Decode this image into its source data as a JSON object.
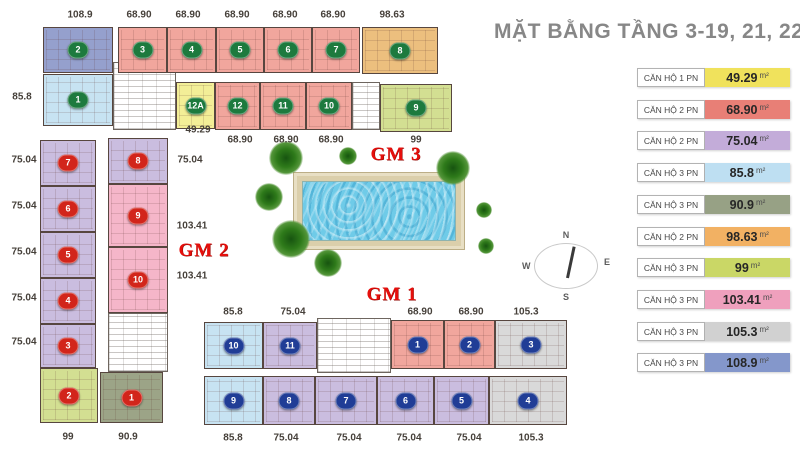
{
  "title": "MẶT BẰNG TẦNG 3-19, 21, 22",
  "legend": {
    "rows": [
      {
        "label": "CĂN HỘ 1 PN",
        "area": "49.29",
        "unit": "m²",
        "color": "#f0e25c"
      },
      {
        "label": "CĂN HỘ 2 PN",
        "area": "68.90",
        "unit": "m²",
        "color": "#e87f76"
      },
      {
        "label": "CĂN HỘ 2 PN",
        "area": "75.04",
        "unit": "m²",
        "color": "#c3acd9"
      },
      {
        "label": "CĂN HỘ 3 PN",
        "area": "85.8",
        "unit": "m²",
        "color": "#bedff2"
      },
      {
        "label": "CĂN HỘ 3 PN",
        "area": "90.9",
        "unit": "m²",
        "color": "#97a185"
      },
      {
        "label": "CĂN HỘ 2 PN",
        "area": "98.63",
        "unit": "m²",
        "color": "#f2b163"
      },
      {
        "label": "CĂN HỘ 3 PN",
        "area": "99",
        "unit": "m²",
        "color": "#cad766"
      },
      {
        "label": "CĂN HỘ 3 PN",
        "area": "103.41",
        "unit": "m²",
        "color": "#efa0bd"
      },
      {
        "label": "CĂN HỘ 3 PN",
        "area": "105.3",
        "unit": "m²",
        "color": "#d1d1d1"
      },
      {
        "label": "CĂN HỘ 3 PN",
        "area": "108.9",
        "unit": "m²",
        "color": "#8497cb"
      }
    ]
  },
  "plan": {
    "fills": {
      "salmon": "#f1a69d",
      "blue": "#95a0cd",
      "lightblue": "#c7e3f2",
      "yellow": "#f3ee97",
      "orange": "#ecbf7e",
      "green99": "#d3df92",
      "graygreen": "#9ca487",
      "purple": "#cabddf",
      "pink": "#f5b6c9",
      "gray": "#d9d9d9"
    },
    "badge_colors": {
      "green": "#1d7a3e",
      "red": "#d2251b",
      "blue": "#203d96"
    },
    "group_labels": [
      {
        "t": "GM 3",
        "x": 396,
        "y": 155
      },
      {
        "t": "GM 2",
        "x": 204,
        "y": 251
      },
      {
        "t": "GM 1",
        "x": 392,
        "y": 295
      }
    ],
    "units": [
      {
        "id": "2",
        "fill": "blue",
        "badge": "green",
        "x": 43,
        "y": 27,
        "w": 70,
        "h": 46
      },
      {
        "id": "3",
        "fill": "salmon",
        "badge": "green",
        "x": 118,
        "y": 27,
        "w": 49,
        "h": 46
      },
      {
        "id": "4",
        "fill": "salmon",
        "badge": "green",
        "x": 167,
        "y": 27,
        "w": 49,
        "h": 46
      },
      {
        "id": "5",
        "fill": "salmon",
        "badge": "green",
        "x": 216,
        "y": 27,
        "w": 48,
        "h": 46
      },
      {
        "id": "6",
        "fill": "salmon",
        "badge": "green",
        "x": 264,
        "y": 27,
        "w": 48,
        "h": 46
      },
      {
        "id": "7",
        "fill": "salmon",
        "badge": "green",
        "x": 312,
        "y": 27,
        "w": 48,
        "h": 46
      },
      {
        "id": "8",
        "fill": "orange",
        "badge": "green",
        "x": 362,
        "y": 27,
        "w": 76,
        "h": 47
      },
      {
        "id": "1",
        "fill": "lightblue",
        "badge": "green",
        "x": 43,
        "y": 74,
        "w": 70,
        "h": 52
      },
      {
        "id": "12A",
        "fill": "yellow",
        "badge": "green",
        "x": 176,
        "y": 82,
        "w": 39,
        "h": 47
      },
      {
        "id": "12",
        "fill": "salmon",
        "badge": "green",
        "x": 215,
        "y": 82,
        "w": 45,
        "h": 48
      },
      {
        "id": "11",
        "fill": "salmon",
        "badge": "green",
        "x": 260,
        "y": 82,
        "w": 46,
        "h": 48
      },
      {
        "id": "10",
        "fill": "salmon",
        "badge": "green",
        "x": 306,
        "y": 82,
        "w": 46,
        "h": 48
      },
      {
        "id": "9",
        "fill": "green99",
        "badge": "green",
        "x": 380,
        "y": 84,
        "w": 72,
        "h": 48
      },
      {
        "id": "7",
        "fill": "purple",
        "badge": "red",
        "x": 40,
        "y": 140,
        "w": 56,
        "h": 46
      },
      {
        "id": "6",
        "fill": "purple",
        "badge": "red",
        "x": 40,
        "y": 186,
        "w": 56,
        "h": 46
      },
      {
        "id": "5",
        "fill": "purple",
        "badge": "red",
        "x": 40,
        "y": 232,
        "w": 56,
        "h": 46
      },
      {
        "id": "4",
        "fill": "purple",
        "badge": "red",
        "x": 40,
        "y": 278,
        "w": 56,
        "h": 46
      },
      {
        "id": "3",
        "fill": "purple",
        "badge": "red",
        "x": 40,
        "y": 324,
        "w": 56,
        "h": 44
      },
      {
        "id": "2",
        "fill": "green99",
        "badge": "red",
        "x": 40,
        "y": 368,
        "w": 58,
        "h": 55
      },
      {
        "id": "1",
        "fill": "graygreen",
        "badge": "red",
        "x": 100,
        "y": 372,
        "w": 63,
        "h": 51
      },
      {
        "id": "8",
        "fill": "purple",
        "badge": "red",
        "x": 108,
        "y": 138,
        "w": 60,
        "h": 46
      },
      {
        "id": "9",
        "fill": "pink",
        "badge": "red",
        "x": 108,
        "y": 184,
        "w": 60,
        "h": 63
      },
      {
        "id": "10",
        "fill": "pink",
        "badge": "red",
        "x": 108,
        "y": 247,
        "w": 60,
        "h": 66
      },
      {
        "id": "10",
        "fill": "lightblue",
        "badge": "blue",
        "x": 204,
        "y": 322,
        "w": 59,
        "h": 47
      },
      {
        "id": "11",
        "fill": "purple",
        "badge": "blue",
        "x": 263,
        "y": 322,
        "w": 54,
        "h": 47
      },
      {
        "id": "1",
        "fill": "salmon",
        "badge": "blue",
        "x": 391,
        "y": 320,
        "w": 53,
        "h": 49
      },
      {
        "id": "2",
        "fill": "salmon",
        "badge": "blue",
        "x": 444,
        "y": 320,
        "w": 51,
        "h": 49
      },
      {
        "id": "3",
        "fill": "gray",
        "badge": "blue",
        "x": 495,
        "y": 320,
        "w": 72,
        "h": 49
      },
      {
        "id": "9",
        "fill": "lightblue",
        "badge": "blue",
        "x": 204,
        "y": 376,
        "w": 59,
        "h": 49
      },
      {
        "id": "8",
        "fill": "purple",
        "badge": "blue",
        "x": 263,
        "y": 376,
        "w": 52,
        "h": 49
      },
      {
        "id": "7",
        "fill": "purple",
        "badge": "blue",
        "x": 315,
        "y": 376,
        "w": 62,
        "h": 49
      },
      {
        "id": "6",
        "fill": "purple",
        "badge": "blue",
        "x": 377,
        "y": 376,
        "w": 57,
        "h": 49
      },
      {
        "id": "5",
        "fill": "purple",
        "badge": "blue",
        "x": 434,
        "y": 376,
        "w": 55,
        "h": 49
      },
      {
        "id": "4",
        "fill": "gray",
        "badge": "blue",
        "x": 489,
        "y": 376,
        "w": 78,
        "h": 49
      }
    ],
    "cores": [
      {
        "x": 113,
        "y": 62,
        "w": 63,
        "h": 68
      },
      {
        "x": 352,
        "y": 82,
        "w": 28,
        "h": 48
      },
      {
        "x": 108,
        "y": 313,
        "w": 60,
        "h": 59
      },
      {
        "x": 317,
        "y": 318,
        "w": 74,
        "h": 55
      }
    ],
    "area_labels": [
      {
        "t": "108.9",
        "x": 80,
        "y": 15
      },
      {
        "t": "68.90",
        "x": 139,
        "y": 15
      },
      {
        "t": "68.90",
        "x": 188,
        "y": 15
      },
      {
        "t": "68.90",
        "x": 237,
        "y": 15
      },
      {
        "t": "68.90",
        "x": 285,
        "y": 15
      },
      {
        "t": "68.90",
        "x": 333,
        "y": 15
      },
      {
        "t": "98.63",
        "x": 392,
        "y": 15
      },
      {
        "t": "85.8",
        "x": 22,
        "y": 97
      },
      {
        "t": "49.29",
        "x": 198,
        "y": 130
      },
      {
        "t": "68.90",
        "x": 240,
        "y": 140
      },
      {
        "t": "68.90",
        "x": 286,
        "y": 140
      },
      {
        "t": "68.90",
        "x": 331,
        "y": 140
      },
      {
        "t": "99",
        "x": 416,
        "y": 140
      },
      {
        "t": "75.04",
        "x": 24,
        "y": 160
      },
      {
        "t": "75.04",
        "x": 190,
        "y": 160
      },
      {
        "t": "75.04",
        "x": 24,
        "y": 206
      },
      {
        "t": "75.04",
        "x": 24,
        "y": 252
      },
      {
        "t": "103.41",
        "x": 192,
        "y": 226
      },
      {
        "t": "75.04",
        "x": 24,
        "y": 298
      },
      {
        "t": "103.41",
        "x": 192,
        "y": 276
      },
      {
        "t": "75.04",
        "x": 24,
        "y": 342
      },
      {
        "t": "99",
        "x": 68,
        "y": 437
      },
      {
        "t": "90.9",
        "x": 128,
        "y": 437
      },
      {
        "t": "85.8",
        "x": 233,
        "y": 312
      },
      {
        "t": "75.04",
        "x": 293,
        "y": 312
      },
      {
        "t": "68.90",
        "x": 420,
        "y": 312
      },
      {
        "t": "68.90",
        "x": 471,
        "y": 312
      },
      {
        "t": "105.3",
        "x": 526,
        "y": 312
      },
      {
        "t": "85.8",
        "x": 233,
        "y": 438
      },
      {
        "t": "75.04",
        "x": 286,
        "y": 438
      },
      {
        "t": "75.04",
        "x": 349,
        "y": 438
      },
      {
        "t": "75.04",
        "x": 409,
        "y": 438
      },
      {
        "t": "75.04",
        "x": 469,
        "y": 438
      },
      {
        "t": "105.3",
        "x": 531,
        "y": 438
      }
    ],
    "pool": {
      "x": 293,
      "y": 172,
      "w": 170,
      "h": 76
    },
    "trees": [
      {
        "x": 286,
        "y": 158,
        "d": 34
      },
      {
        "x": 348,
        "y": 156,
        "d": 18
      },
      {
        "x": 269,
        "y": 197,
        "d": 28
      },
      {
        "x": 291,
        "y": 239,
        "d": 38
      },
      {
        "x": 328,
        "y": 263,
        "d": 28
      },
      {
        "x": 453,
        "y": 168,
        "d": 34
      },
      {
        "x": 484,
        "y": 210,
        "d": 16
      },
      {
        "x": 486,
        "y": 246,
        "d": 16
      }
    ],
    "compass": {
      "cx": 566,
      "cy": 266,
      "n": "N",
      "e": "E",
      "s": "S",
      "w": "W"
    }
  }
}
